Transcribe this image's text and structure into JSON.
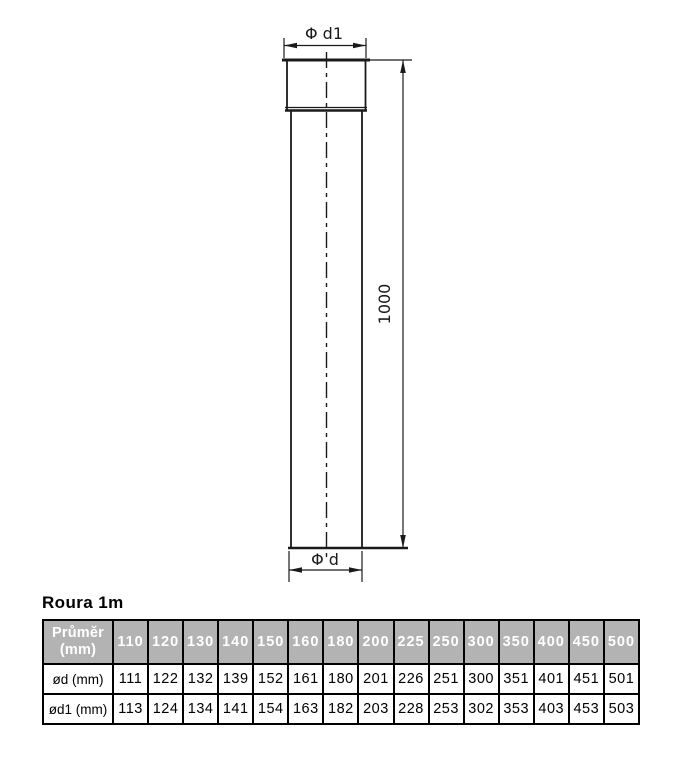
{
  "title": "Roura 1m",
  "drawing": {
    "top_diameter_label": "Φ d1",
    "bottom_diameter_label": "Φ d",
    "length_label": "1000"
  },
  "table": {
    "corner_header": {
      "line1": "Průměr",
      "line2": "(mm)"
    },
    "diameters": [
      "110",
      "120",
      "130",
      "140",
      "150",
      "160",
      "180",
      "200",
      "225",
      "250",
      "300",
      "350",
      "400",
      "450",
      "500"
    ],
    "rows": [
      {
        "label": "ød (mm)",
        "values": [
          "111",
          "122",
          "132",
          "139",
          "152",
          "161",
          "180",
          "201",
          "226",
          "251",
          "300",
          "351",
          "401",
          "451",
          "501"
        ]
      },
      {
        "label": "ød1 (mm)",
        "values": [
          "113",
          "124",
          "134",
          "141",
          "154",
          "163",
          "182",
          "203",
          "228",
          "253",
          "302",
          "353",
          "403",
          "453",
          "503"
        ]
      }
    ]
  },
  "colors": {
    "header_bg": "#b3b3b3",
    "header_text": "#ffffff",
    "line": "#1a1a1a"
  }
}
